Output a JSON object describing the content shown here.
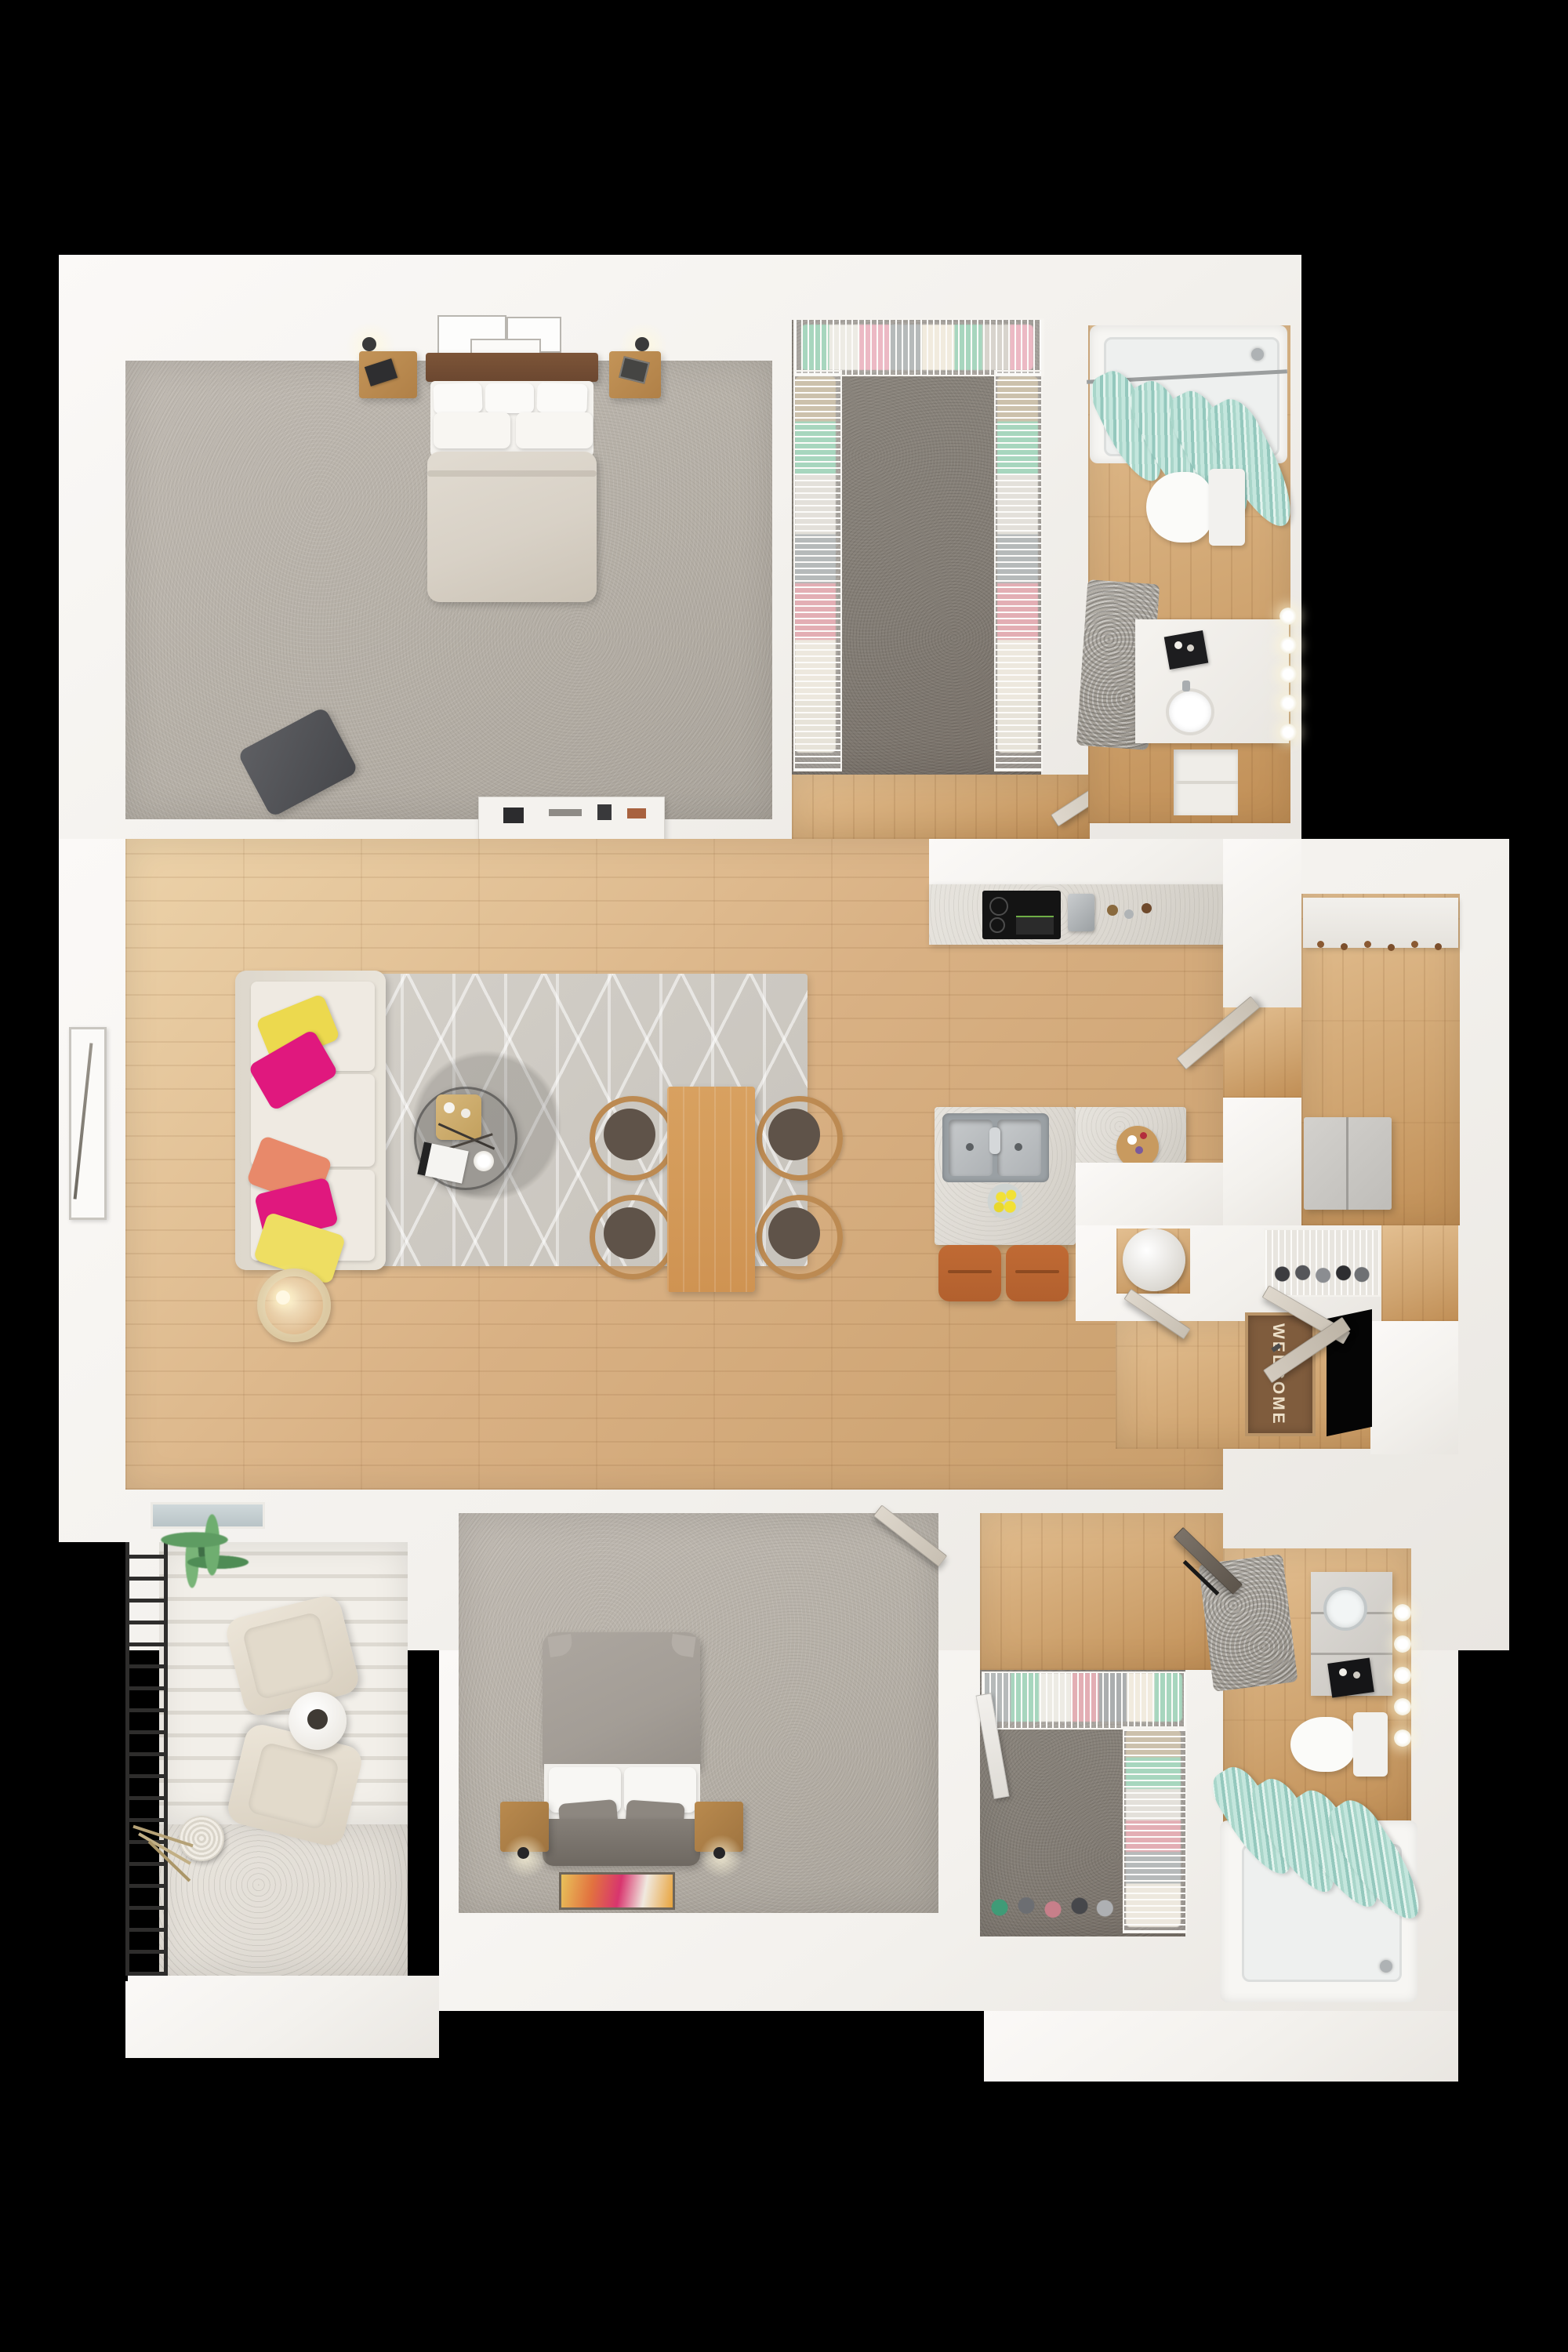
{
  "scene": {
    "kind": "3d-rendered floor plan, top-down view",
    "apartment": "two bedroom / two bath with balcony",
    "background": "#000000"
  },
  "welcome_mat": {
    "text": "WELCOME"
  },
  "colors": {
    "wall": "#f3f1ed",
    "wood-mid": "#d9b184",
    "wood-warm": "#cfa470",
    "carpet-light": "#b5afa6",
    "carpet-dark": "#837d75",
    "marble": "#dcd8d1",
    "teal": "#94c8bd",
    "rug": "#c7c3bc",
    "door": "#c8c0b3",
    "sofa": "#e9e4da",
    "pillow-yellow": "#ecd94e",
    "pillow-magenta": "#e0187e",
    "pillow-coral": "#e8896a",
    "stool-leather": "#b2602e",
    "dining-wood": "#cf9352",
    "seat-brown": "#5f5349",
    "headboard-walnut": "#6b4730",
    "nightstand-oak": "#b08047",
    "duvet-beige": "#d8d1c6",
    "duvet-gray": "#a39d96",
    "mat-brown": "#7f5c3d",
    "railing-black": "#2e2d2c",
    "palm-green": "#5e9c62",
    "art-accent": "#d8356e"
  },
  "rooms": [
    {
      "id": "bedroom-1",
      "floor": "light gray carpet",
      "furniture": [
        "double bed with walnut headboard",
        "white pillows",
        "beige duvet",
        "left nightstand with lamp and book",
        "right nightstand with lamp and photo frame",
        "wall art set of frames",
        "dark accent chair",
        "white dresser with decor"
      ]
    },
    {
      "id": "walk-in-closet-1",
      "floor": "dark gray carpet",
      "furniture": [
        "white wire shelving",
        "hanging clothes in green, pink, gray and cream"
      ]
    },
    {
      "id": "bathroom-1",
      "floor": "wood plank",
      "furniture": [
        "bathtub with shower head",
        "teal striped shower curtain",
        "toilet",
        "white vanity with sink and black tray",
        "hollywood mirror lights",
        "gray shag rug",
        "linen niche",
        "door"
      ]
    },
    {
      "id": "living-room",
      "floor": "wood plank",
      "furniture": [
        "beige three-seat sofa",
        "yellow, magenta and coral throw pillows",
        "gray geometric area rug",
        "round glass coffee table with gold tray and magazine",
        "ring floor lamp",
        "tall wall art frame",
        "sliding balcony door"
      ]
    },
    {
      "id": "dining-area",
      "floor": "wood plank",
      "furniture": [
        "rectangular wood dining table",
        "four wood chairs with brown seats"
      ]
    },
    {
      "id": "kitchen",
      "floor": "wood plank",
      "furniture": [
        "counter with black cooktop",
        "coffee maker",
        "kitchen island with stainless double sink",
        "yellow flowers",
        "round serving board",
        "two cognac leather bar stools",
        "open door to hallway"
      ]
    },
    {
      "id": "hallway-laundry",
      "floor": "wood plank",
      "furniture": [
        "white counter with hanging rail",
        "gray refrigerator"
      ]
    },
    {
      "id": "entry",
      "floor": "wood plank",
      "furniture": [
        "welcome mat",
        "open front door",
        "utility closet with round water heater",
        "coat closet with wire shelf and shoes"
      ]
    },
    {
      "id": "balcony",
      "floor": "striped concrete deck",
      "furniture": [
        "black metal railing",
        "palm plant",
        "two beige lounge chairs",
        "round white side table",
        "vase with dried grass"
      ]
    },
    {
      "id": "bedroom-2",
      "floor": "light gray carpet",
      "furniture": [
        "double bed with gray duvet",
        "white and gray pillows",
        "two nightstands with black lamps",
        "colorful abstract art",
        "door"
      ]
    },
    {
      "id": "closet-2",
      "floor": "dark gray carpet",
      "furniture": [
        "wire shelving",
        "folded clothes",
        "shoe rows",
        "white door"
      ]
    },
    {
      "id": "bathroom-2",
      "floor": "wood plank",
      "furniture": [
        "gray vanity with vessel sink and black tray",
        "hollywood mirror lights",
        "toilet",
        "bathtub",
        "teal striped shower curtain",
        "gray shag rug",
        "dark door"
      ]
    }
  ]
}
